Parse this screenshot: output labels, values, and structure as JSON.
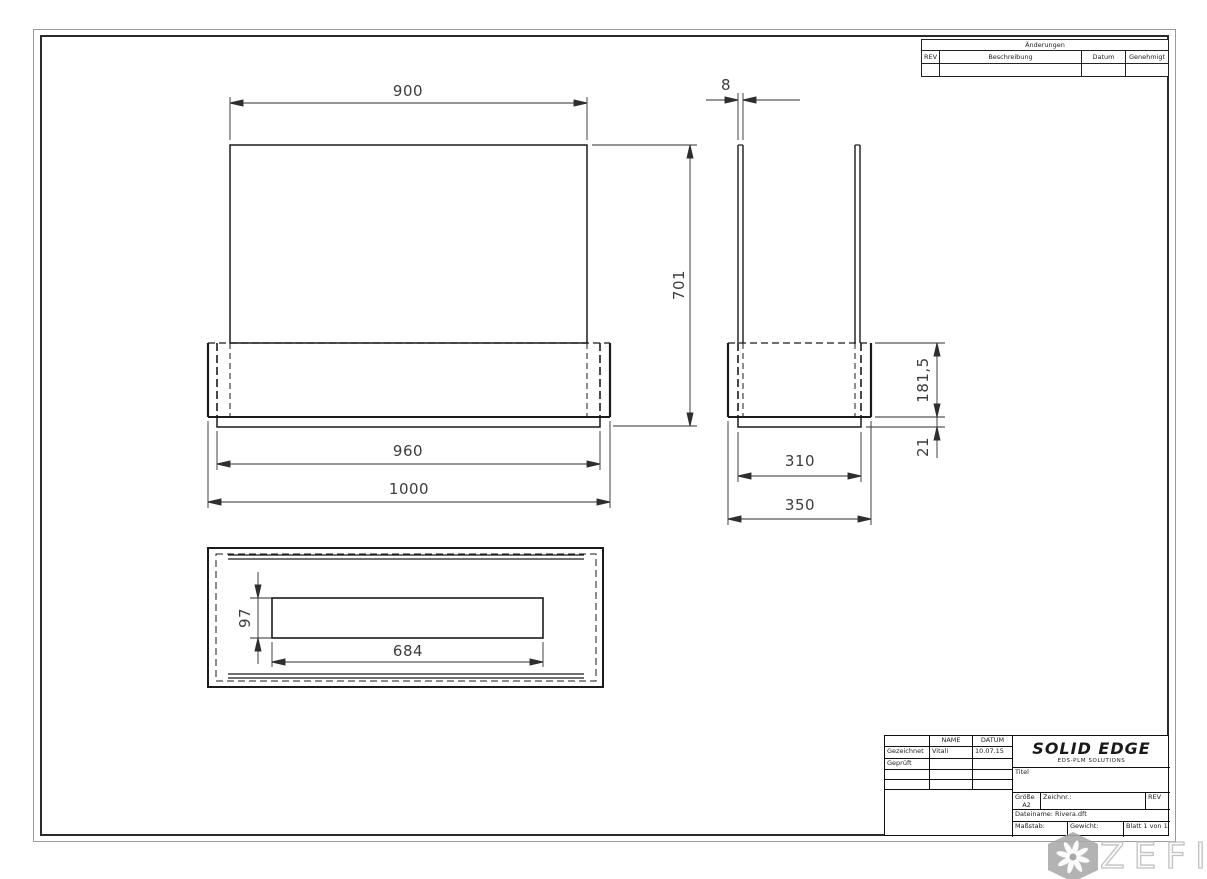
{
  "sheet": {
    "background": "#ffffff",
    "line_color": "#1b1b1b",
    "dim_color": "#3d3d3d"
  },
  "revisions": {
    "title": "Änderungen",
    "columns": [
      "REV",
      "Beschreibung",
      "Datum",
      "Genehmigt"
    ]
  },
  "titleblock": {
    "name_header": "NAME",
    "date_header": "DATUM",
    "rows": [
      {
        "label": "Gezeichnet",
        "name": "Vitali",
        "date": "10.07.15"
      },
      {
        "label": "Geprüft",
        "name": "",
        "date": ""
      }
    ],
    "logo": "SOLID EDGE",
    "logo_sub": "EDS-PLM SOLUTIONS",
    "title_label": "Titel",
    "size_label": "Größe",
    "size_value": "A2",
    "drawing_no_label": "Zeichnr.:",
    "rev_label": "REV",
    "filename_label": "Dateiname: Rivera.dft",
    "scale_label": "Maßstab:",
    "weight_label": "Gewicht:",
    "sheet_label": "Blatt 1 von 1"
  },
  "views": {
    "front": {
      "dims": {
        "top_width": "900",
        "height": "701",
        "inner_base_width": "960",
        "base_width": "1000"
      }
    },
    "side": {
      "dims": {
        "wall_thickness": "8",
        "base_height": "181,5",
        "lip_height": "21",
        "inner_base_depth": "310",
        "base_depth": "350"
      }
    },
    "top": {
      "dims": {
        "slot_depth": "97",
        "slot_length": "684"
      }
    }
  },
  "watermark": {
    "text": "ZEFIRE",
    "icon": "snowflake-swirl-icon",
    "badge_color": "#a8a8a8",
    "text_color": "#c2c2c2"
  }
}
